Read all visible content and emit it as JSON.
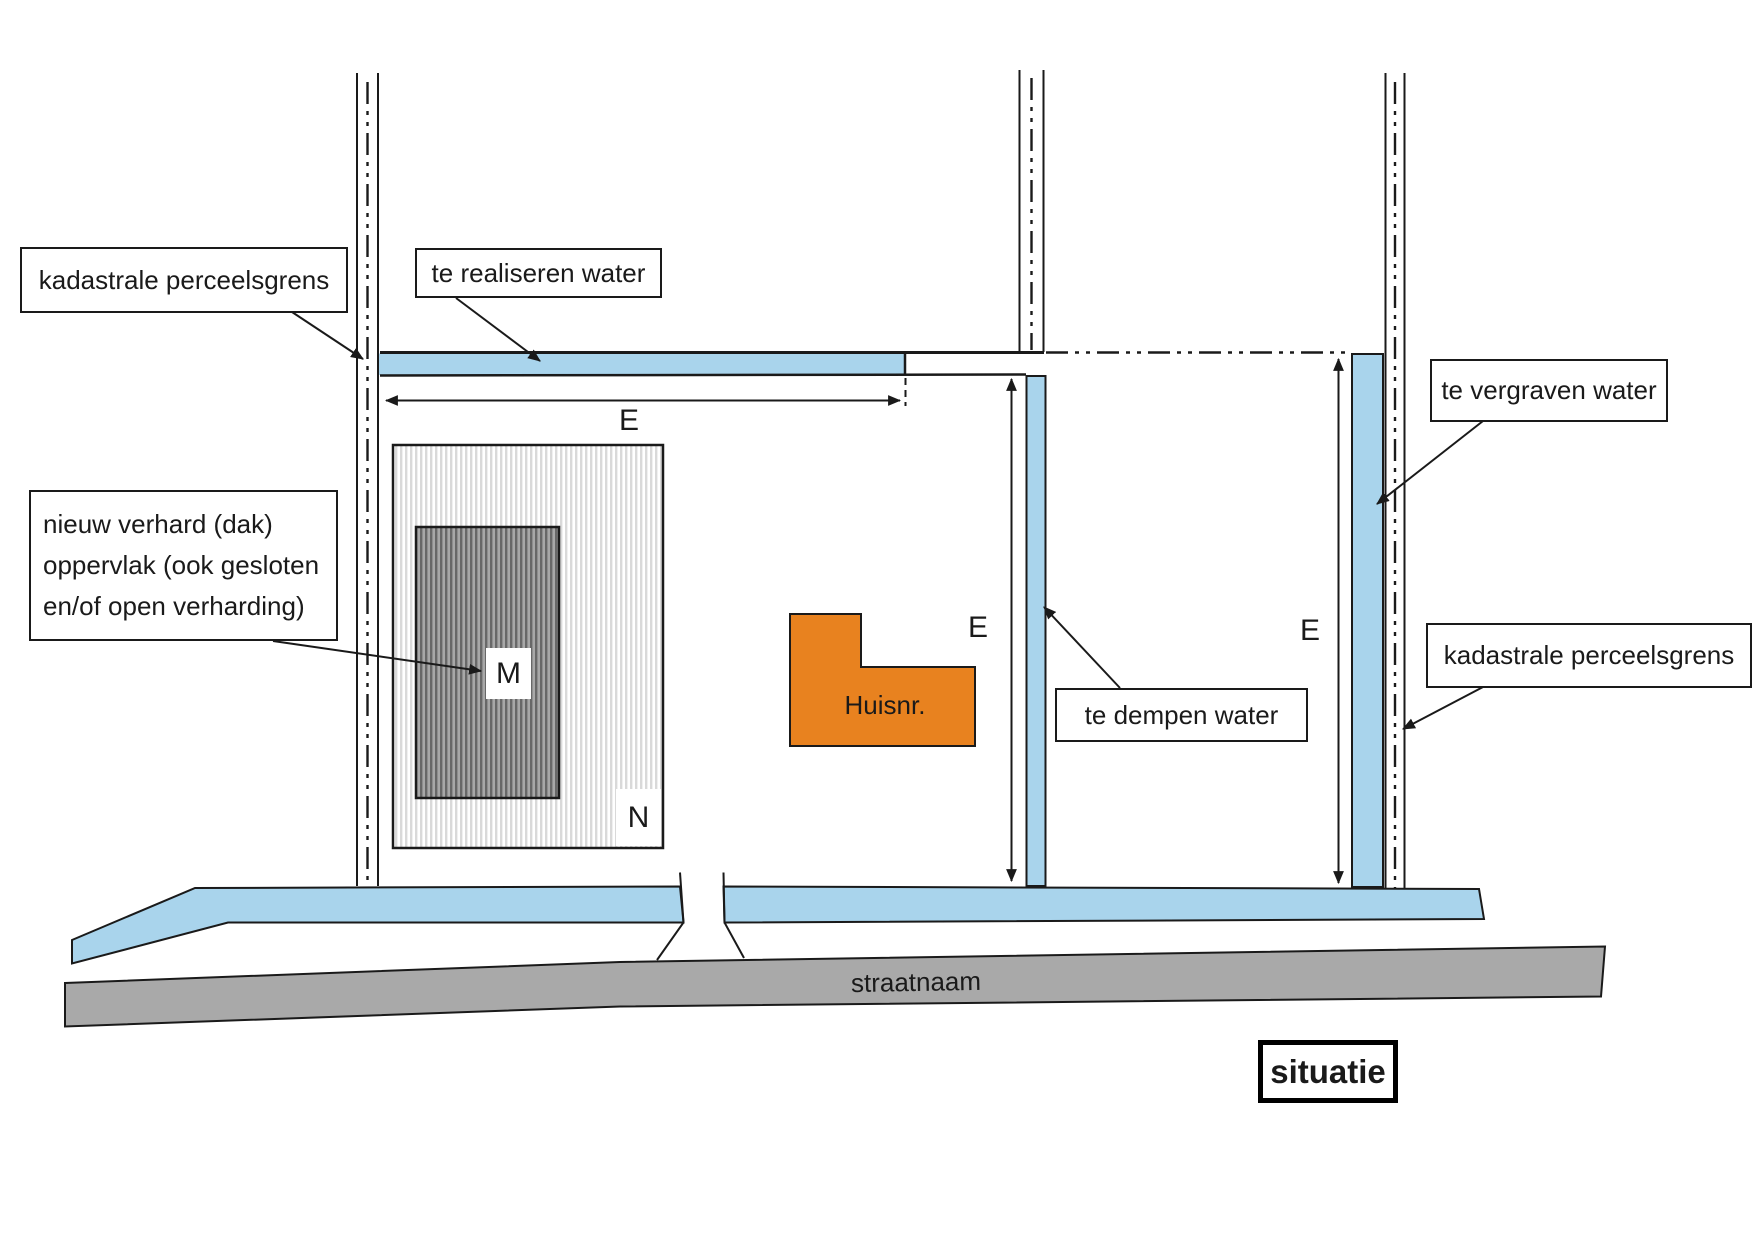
{
  "colors": {
    "water": "#a9d4ec",
    "building": "#e8821f",
    "street": "#a9a9a9",
    "line": "#1a1a1a"
  },
  "labels": {
    "parcel_boundary_left": "kadastrale perceelsgrens",
    "water_new": "te realiseren water",
    "paved_surface_lines": [
      "nieuw verhard (dak)",
      "oppervlak (ook gesloten",
      "en/of open verharding)"
    ],
    "water_fill": "te dempen water",
    "water_excavate": "te vergraven water",
    "parcel_boundary_right": "kadastrale perceelsgrens",
    "building": "Huisnr.",
    "street": "straatnaam",
    "title": "situatie"
  },
  "dimensions": {
    "top": "E",
    "middle": "E",
    "right": "E"
  },
  "area_marks": {
    "roof": "M",
    "paved": "N"
  }
}
